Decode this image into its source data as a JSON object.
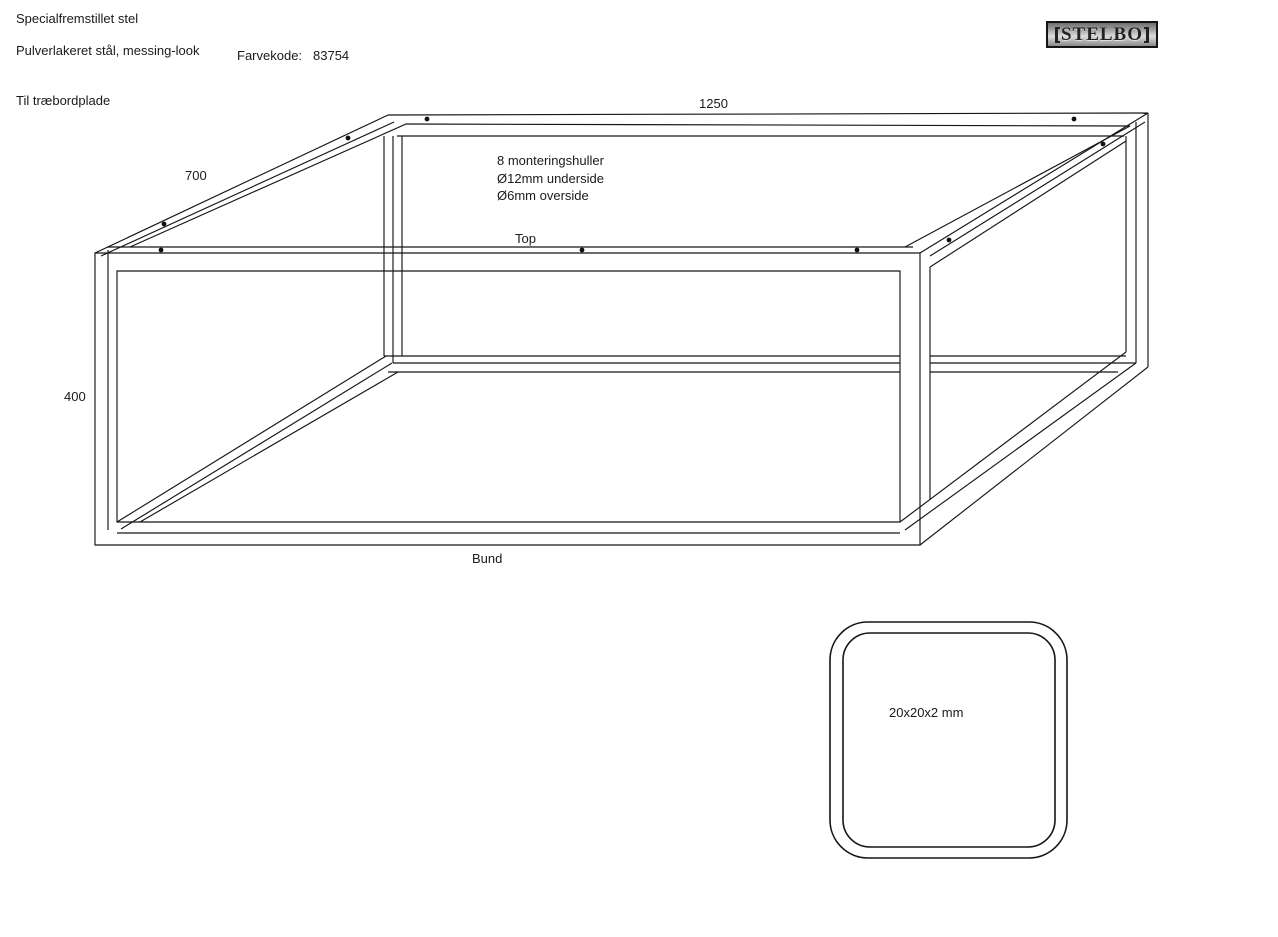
{
  "page": {
    "background": "#ffffff",
    "line_color": "#161616"
  },
  "header": {
    "title": "Specialfremstillet stel",
    "material": "Pulverlakeret stål, messing-look",
    "color_code_label": "Farvekode:",
    "color_code_value": "83754",
    "plate_note": "Til træbordplade",
    "logo_text": "STELBO"
  },
  "drawing": {
    "dimensions": {
      "length": "1250",
      "depth": "700",
      "height": "400"
    },
    "labels": {
      "top": "Top",
      "bottom": "Bund"
    },
    "holes_note": [
      "8 monteringshuller",
      "Ø12mm underside",
      "Ø6mm overside"
    ]
  },
  "section_detail": {
    "label": "20x20x2 mm"
  }
}
